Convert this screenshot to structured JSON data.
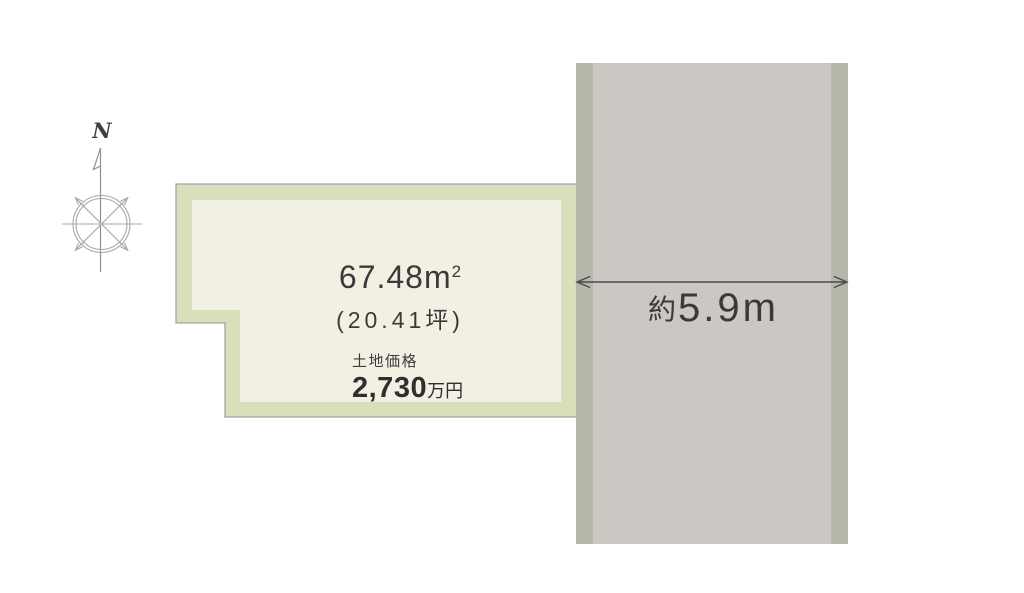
{
  "compass": {
    "north_label": "N"
  },
  "land_plot": {
    "area_value": "67.48",
    "area_unit_base": "m",
    "area_unit_sup": "2",
    "tsubo_text": "(20.41坪)",
    "price_label": "土地価格",
    "price_value": "2,730",
    "price_unit": "万円"
  },
  "road": {
    "width_prefix": "約",
    "width_value": "5.9",
    "width_unit": "m"
  },
  "colors": {
    "plot-fill": "#f2efe3",
    "plot-band": "#d9dfba",
    "plot-outline": "#a3a3a0",
    "road-fill": "#cbc7c3",
    "road-edge": "#b6b7a9",
    "line": "#4a4a4a",
    "text": "#3a3a3a",
    "compass": "#a8a8a4"
  }
}
